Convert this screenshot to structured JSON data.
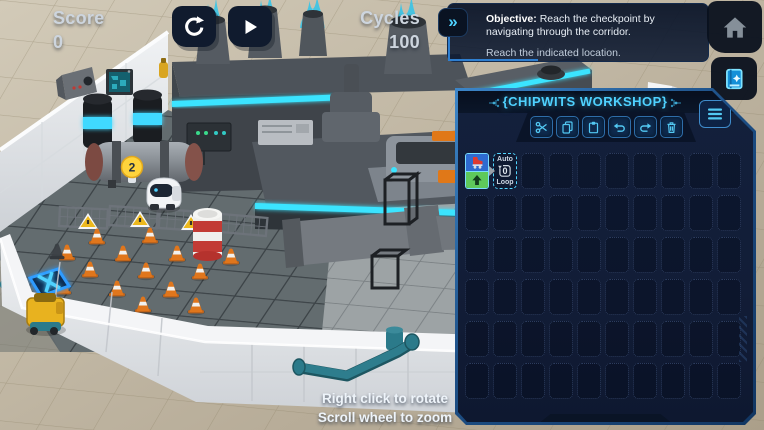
{
  "hud": {
    "score_label": "Score",
    "score_value": "0",
    "cycles_label": "Cycles",
    "cycles_value": "100"
  },
  "sim_controls": {
    "reset_icon": "circular-reset-arrow",
    "play_icon": "play-triangle"
  },
  "objective": {
    "expand_icon": "double-chevron-right",
    "chevron_glyph": "»",
    "title": "Objective:",
    "text": "Reach the checkpoint by navigating through the corridor.",
    "subtext": "Reach the indicated location."
  },
  "nav": {
    "home_icon": "home",
    "manual_icon": "book-with-star"
  },
  "workshop": {
    "title": "{CHIPWITS WORKSHOP}",
    "menu_icon": "hamburger-menu",
    "toolbar": [
      {
        "name": "cut",
        "icon": "scissors"
      },
      {
        "name": "copy",
        "icon": "document-pages"
      },
      {
        "name": "paste",
        "icon": "clipboard"
      },
      {
        "name": "undo",
        "icon": "undo-arrow"
      },
      {
        "name": "redo",
        "icon": "redo-arrow"
      },
      {
        "name": "delete",
        "icon": "trash-can"
      }
    ],
    "grid": {
      "columns": 10,
      "rows": 6
    },
    "program": {
      "move_chip": {
        "top_icon": "red-skate-move",
        "bottom_icon": "up-arrow"
      },
      "connector_icon": "small-right-triangle",
      "auto_loop": {
        "top_label": "Auto",
        "counter": "0",
        "bottom_label": "Loop"
      }
    }
  },
  "scene": {
    "thought_badge": "2",
    "hint_line1": "Right click to rotate",
    "hint_line2": "Scroll wheel to zoom",
    "objects": [
      "factory",
      "smokestacks-with-plasma-flames",
      "hero-robot",
      "thought-bulb-badge",
      "traffic-cones",
      "warning-fences",
      "striped-barrel",
      "checkpoint-tile",
      "yellow-robot",
      "capacitor-cylinders",
      "storage-tank",
      "security-camera",
      "wall-monitor",
      "teal-pipes",
      "exhaust-pipe",
      "white-block-walls"
    ]
  },
  "colors": {
    "accent_cyan": "#4fd2ff",
    "neon_strip": "#3be4ff",
    "panel_navy": "#121d37",
    "panel_border_blue": "#2e6fb0",
    "hud_text": "#cdd5de",
    "cone_orange": "#df7a1c",
    "checkpoint_blue": "#2f9bff",
    "barrel_red": "#c23b35",
    "robot_yellow": "#e8b21f",
    "chip_green": "#5ec95b",
    "chip_blue": "#2e6bd0"
  }
}
